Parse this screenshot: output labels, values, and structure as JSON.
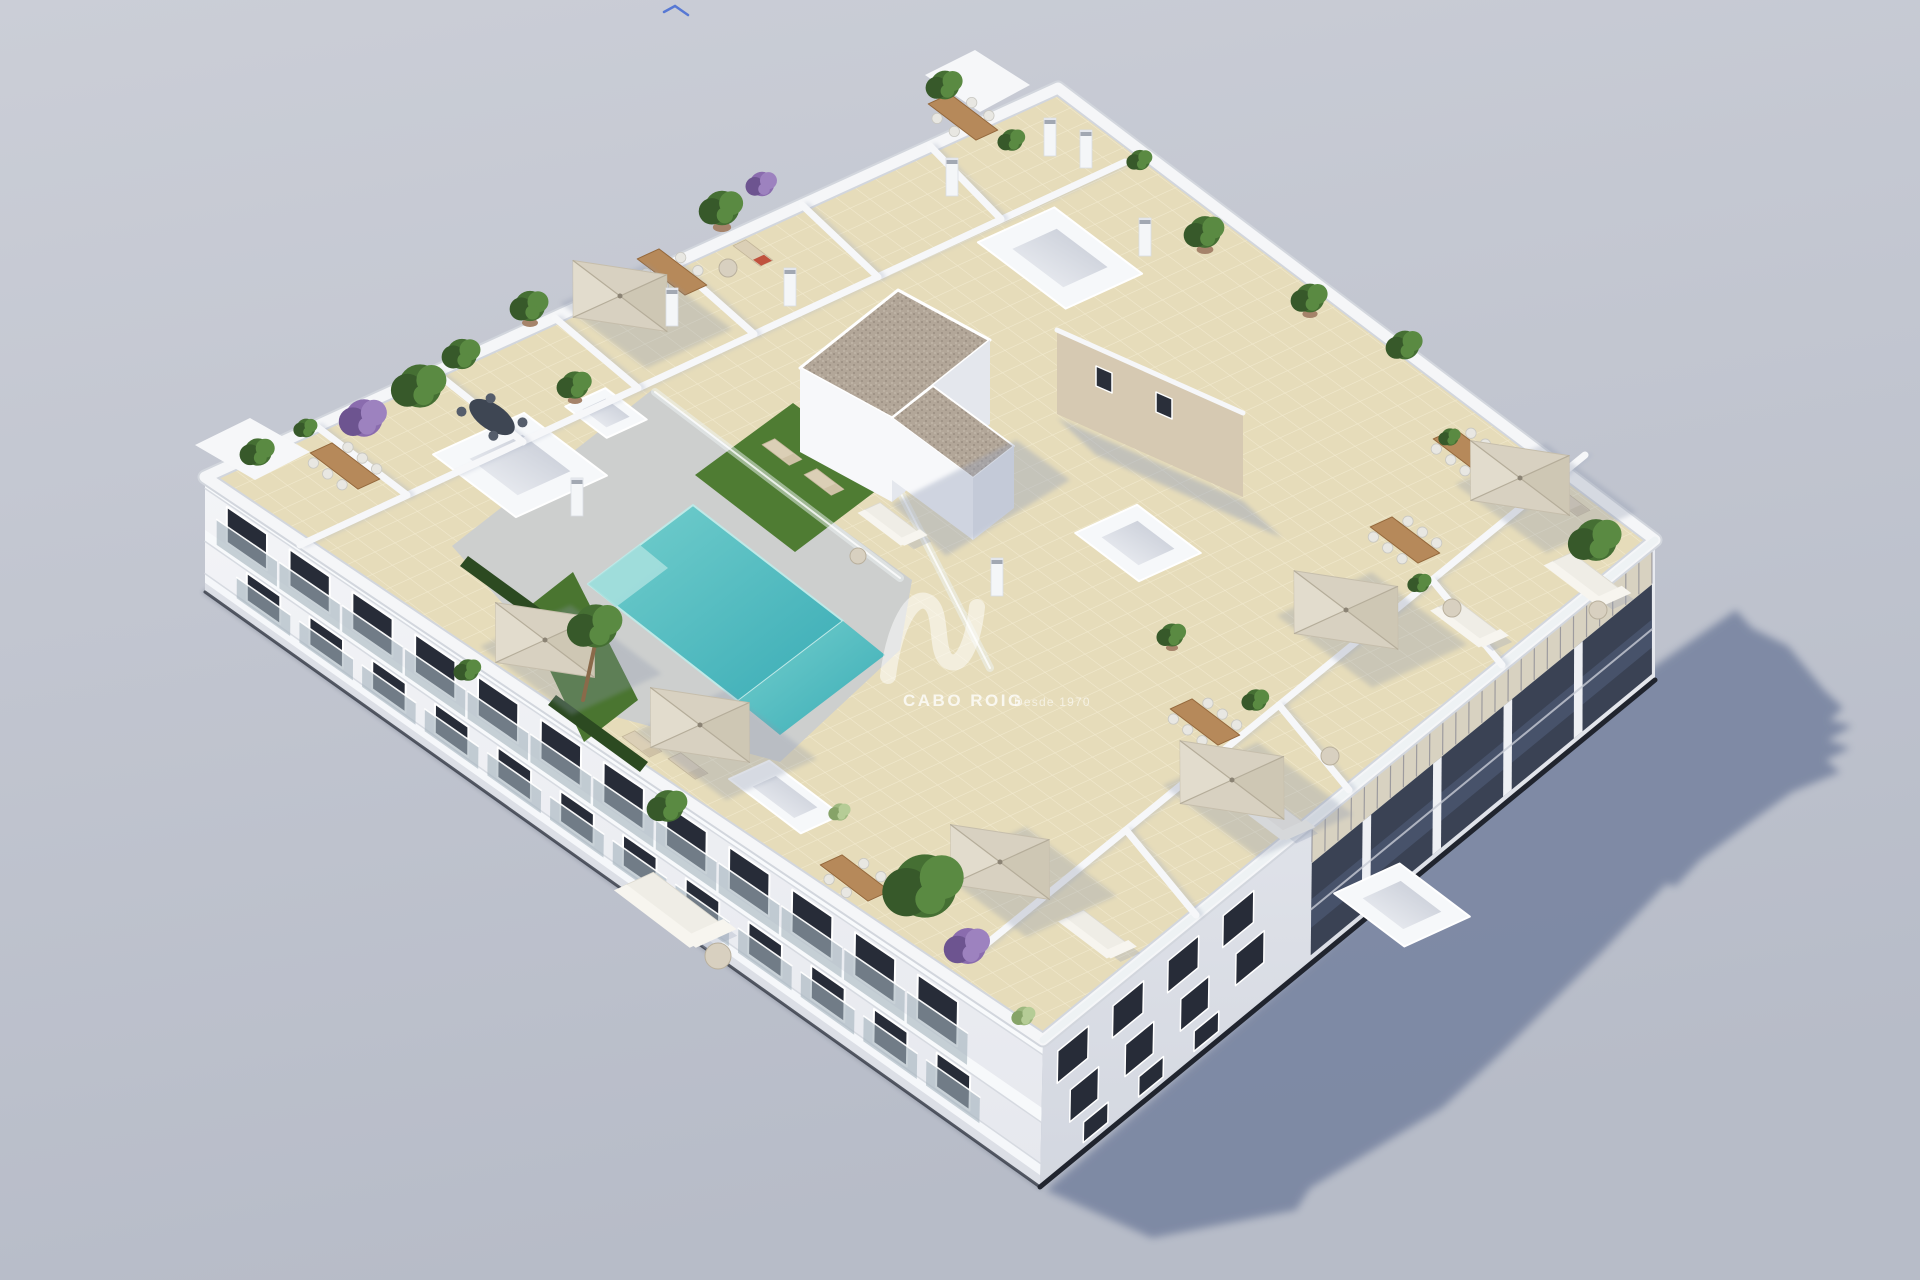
{
  "watermark": {
    "brand": "CABO ROIG",
    "tagline": "Desde 1970"
  },
  "palette": {
    "background_top": "#cbced7",
    "background_bottom": "#b7bcc8",
    "ground_shadow": "#7a86a2",
    "roof_tile": "#e6dcba",
    "grout": "#f2eacf",
    "wall_white": "#f5f6f8",
    "wall_shade": "#d7dae2",
    "tan_wall": "#d6c9b2",
    "pool_light": "#74cfcd",
    "pool_deep": "#3aacb6",
    "grass": "#4f7c33",
    "parasol": "#d8d1c1",
    "wood": "#b6895a",
    "gravel_roof": "#b2a698",
    "facade_recess": "#3a4254",
    "window_dark": "#272c38",
    "purple_bush": "#8a6cae"
  },
  "scene": {
    "u": [
      0.797,
      0.603
    ],
    "v": [
      -0.91,
      0.415
    ],
    "roof": {
      "quad": [
        [
          1058,
          88
        ],
        [
          1655,
          540
        ],
        [
          1043,
          1040
        ],
        [
          205,
          477
        ]
      ]
    },
    "facadeSW": {
      "top": [
        [
          205,
          477
        ],
        [
          1043,
          1040
        ]
      ],
      "bot": [
        [
          205,
          592
        ],
        [
          1040,
          1187
        ]
      ],
      "bands": [
        {
          "v0": 0.0,
          "v1": 0.1,
          "f": "#f8fafc"
        },
        {
          "v0": 0.46,
          "v1": 0.56,
          "f": "#f7f9fb"
        },
        {
          "v0": 0.84,
          "v1": 0.92,
          "f": "#f5f7fa"
        },
        {
          "v0": 0.92,
          "v1": 1.0,
          "f": "#dcdfe6"
        }
      ],
      "lines": [
        0.1,
        0.56,
        0.84
      ],
      "rows": [
        {
          "v0": 0.13,
          "v1": 0.44,
          "w": 0.048,
          "slots": [
            0.05,
            0.125,
            0.2,
            0.275,
            0.35,
            0.425,
            0.5,
            0.575,
            0.65,
            0.725,
            0.8,
            0.875
          ],
          "glass": [
            0.3,
            0.52
          ]
        },
        {
          "v0": 0.58,
          "v1": 0.82,
          "w": 0.04,
          "slots": [
            0.07,
            0.145,
            0.22,
            0.295,
            0.37,
            0.445,
            0.52,
            0.595,
            0.67,
            0.745,
            0.82,
            0.895
          ],
          "glass": [
            0.68,
            0.86
          ]
        }
      ]
    },
    "facadeSE": {
      "top": [
        [
          1043,
          1040
        ],
        [
          1655,
          540
        ]
      ],
      "bot": [
        [
          1040,
          1187
        ],
        [
          1655,
          680
        ]
      ],
      "winRows": [
        {
          "v0": 0.16,
          "v1": 0.38,
          "w": 0.05,
          "slots": [
            0.05,
            0.14,
            0.23,
            0.32
          ]
        },
        {
          "v0": 0.5,
          "v1": 0.72,
          "w": 0.046,
          "slots": [
            0.07,
            0.16,
            0.25,
            0.34
          ]
        },
        {
          "v0": 0.8,
          "v1": 0.94,
          "w": 0.04,
          "slots": [
            0.09,
            0.18,
            0.27
          ]
        }
      ],
      "pergola": {
        "t0": 0.44,
        "t1": 0.995,
        "v0": 0.02,
        "v1": 0.3,
        "slats": 26
      },
      "recess": {
        "t0": 0.44,
        "t1": 0.995,
        "v0": 0.3,
        "v1": 0.94,
        "piers": [
          0.53,
          0.645,
          0.76,
          0.875
        ],
        "pw": 0.014,
        "sheen": [
          0.55,
          0.75
        ]
      }
    },
    "items": [
      {
        "t": "poly",
        "name": "sky-ground",
        "p": "0,0 1920,0 1920,1280 0,1280",
        "f": "url(#gBg)"
      },
      {
        "t": "poly",
        "name": "building-cast-shadow",
        "f": "#7a86a2",
        "o": 0.92,
        "fl": "b4",
        "p": "1652,668 1736,610 1752,628 1788,646 1806,668 1824,690 1843,708 1830,720 1852,726 1828,740 1850,748 1826,760 1840,772 1792,792 1756,818 1700,860 1676,886 1666,884 1602,952 1502,1052 1442,1108 1310,1188 1296,1210 1152,1238 1046,1190"
      },
      {
        "t": "line",
        "name": "base-ao-sw",
        "a": [
          205,
          592
        ],
        "b": [
          1040,
          1187
        ],
        "s": "#79808f",
        "w": 5,
        "o": 0.45,
        "fl": "b2"
      },
      {
        "t": "facadeSW"
      },
      {
        "t": "facadeSE"
      },
      {
        "t": "roof"
      },
      {
        "t": "poly",
        "name": "pool-deck",
        "p": "452,546 652,390 912,580 900,650 780,762 598,712",
        "f": "#cdcfce"
      },
      {
        "t": "poly",
        "name": "grass-loungers",
        "p": "695,475 793,403 893,478 795,552",
        "f": "#4f7c33"
      },
      {
        "t": "poly",
        "name": "grass-side",
        "p": "522,612 573,572 638,700 584,742",
        "f": "#4a7530"
      },
      {
        "t": "poly",
        "name": "hedge",
        "p": "468,556 556,620 548,630 460,566",
        "f": "#2c4a21"
      },
      {
        "t": "poly",
        "name": "hedge",
        "p": "556,695 648,762 640,772 548,705",
        "f": "#2c4a21"
      },
      {
        "t": "poly",
        "name": "pool-main",
        "p": "588,584 693,505 843,621 738,701",
        "f": "url(#gPool)",
        "s": "#bfe9e7",
        "w": 2
      },
      {
        "t": "poly",
        "name": "pool-ext",
        "p": "738,701 843,621 885,655 780,735",
        "f": "url(#gPool)"
      },
      {
        "t": "poly",
        "name": "pool-steps",
        "p": "588,584 640,545 668,568 616,607",
        "f": "#a5dfdd",
        "o": 0.9
      },
      {
        "t": "fence",
        "a": [
          655,
          392
        ],
        "b": [
          900,
          578
        ]
      },
      {
        "t": "fence",
        "a": [
          895,
          482
        ],
        "b": [
          990,
          668
        ]
      },
      {
        "t": "lounger",
        "c": [
          782,
          452
        ]
      },
      {
        "t": "lounger",
        "c": [
          824,
          482
        ]
      },
      {
        "t": "lounger",
        "c": [
          642,
          744
        ]
      },
      {
        "t": "lounger",
        "c": [
          688,
          766
        ]
      },
      {
        "t": "poly",
        "name": "stair-core-roof",
        "p": "800,368 898,290 990,340 892,418",
        "f": "url(#pGravel)",
        "s": "#ffffff",
        "w": 3
      },
      {
        "t": "poly",
        "name": "stair-core-wall",
        "p": "800,368 892,418 892,502 800,452",
        "f": "#f7f8fa"
      },
      {
        "t": "poly",
        "name": "stair-core-wall-shade",
        "p": "892,418 990,340 990,424 892,502",
        "f": "#e4e7ed"
      },
      {
        "t": "poly",
        "name": "stair-core-roof",
        "p": "892,418 933,386 1014,446 973,478",
        "f": "url(#pGravel)",
        "s": "#ffffff",
        "w": 2
      },
      {
        "t": "poly",
        "name": "stair-core-wall",
        "p": "892,418 973,478 973,540 892,480",
        "f": "#f7f8fa"
      },
      {
        "t": "poly",
        "name": "stair-core-wall-shade",
        "p": "973,478 1014,446 1014,508 973,540",
        "f": "#e4e7ed"
      },
      {
        "t": "poly",
        "name": "stair-core-shadow",
        "p": "892,504 1016,440 1070,480 946,556",
        "f": "#96a1ba",
        "o": 0.4,
        "fl": "b2"
      },
      {
        "t": "poly",
        "name": "tan-wall",
        "p": "1057,330 1243,413 1243,497 1057,414",
        "f": "#d6c9b2"
      },
      {
        "t": "line",
        "name": "tan-wall-cap",
        "a": [
          1057,
          330
        ],
        "b": [
          1243,
          413
        ],
        "s": "#f6f7f9",
        "w": 5
      },
      {
        "t": "poly",
        "name": "tan-wall-window",
        "p": "1096,366 1112,373 1112,393 1096,386",
        "f": "#2a2f3a",
        "s": "#ffffff",
        "w": 1.5
      },
      {
        "t": "poly",
        "name": "tan-wall-window",
        "p": "1156,392 1172,399 1172,419 1156,412",
        "f": "#2a2f3a",
        "s": "#ffffff",
        "w": 1.5
      },
      {
        "t": "poly",
        "name": "tan-wall-shadow",
        "p": "1057,418 1243,501 1282,538 1096,455",
        "f": "#97a2bb",
        "o": 0.45,
        "fl": "b2"
      },
      {
        "t": "sky",
        "c": [
          1060,
          258
        ],
        "su": 55,
        "sv": 42
      },
      {
        "t": "sky",
        "c": [
          520,
          465
        ],
        "su": 52,
        "sv": 50
      },
      {
        "t": "sky",
        "c": [
          606,
          413
        ],
        "su": 26,
        "sv": 22
      },
      {
        "t": "sky",
        "c": [
          1402,
          905
        ],
        "su": 44,
        "sv": 36
      },
      {
        "t": "sky",
        "c": [
          785,
          797
        ],
        "su": 45,
        "sv": 22
      },
      {
        "t": "sky",
        "c": [
          1138,
          543
        ],
        "su": 40,
        "sv": 34
      },
      {
        "t": "wall",
        "a": [
          300,
          545
        ],
        "b": [
          1125,
          162
        ]
      },
      {
        "t": "wall",
        "a": [
          407,
          495
        ],
        "b": [
          316,
          426
        ]
      },
      {
        "t": "wall",
        "a": [
          523,
          442
        ],
        "b": [
          435,
          372
        ]
      },
      {
        "t": "wall",
        "a": [
          638,
          388
        ],
        "b": [
          555,
          318
        ]
      },
      {
        "t": "wall",
        "a": [
          754,
          334
        ],
        "b": [
          674,
          263
        ]
      },
      {
        "t": "wall",
        "a": [
          878,
          277
        ],
        "b": [
          802,
          205
        ]
      },
      {
        "t": "wall",
        "a": [
          1001,
          219
        ],
        "b": [
          930,
          146
        ]
      },
      {
        "t": "wall",
        "a": [
          973,
          955
        ],
        "b": [
          1585,
          455
        ]
      },
      {
        "t": "wall",
        "a": [
          1126,
          830
        ],
        "b": [
          1196,
          915
        ]
      },
      {
        "t": "wall",
        "a": [
          1279,
          705
        ],
        "b": [
          1349,
          790
        ]
      },
      {
        "t": "wall",
        "a": [
          1432,
          580
        ],
        "b": [
          1502,
          665
        ]
      },
      {
        "t": "poly",
        "name": "parapet-planter",
        "p": "195,445 250,418 310,452 255,480",
        "f": "#f6f7f9"
      },
      {
        "t": "poly",
        "name": "parapet-planter",
        "p": "925,75 975,50 1030,85 980,112",
        "f": "#f6f7f9"
      },
      {
        "t": "tableW",
        "c": [
          345,
          466
        ],
        "n": 6
      },
      {
        "t": "tableW",
        "c": [
          672,
          272
        ],
        "n": 4
      },
      {
        "t": "tableW",
        "c": [
          963,
          117
        ],
        "n": 4
      },
      {
        "t": "tableW",
        "c": [
          1468,
          452
        ],
        "n": 6
      },
      {
        "t": "tableW",
        "c": [
          1405,
          540
        ],
        "n": 6
      },
      {
        "t": "tableW",
        "c": [
          1205,
          722
        ],
        "n": 6
      },
      {
        "t": "tableW",
        "c": [
          855,
          878
        ],
        "n": 4
      },
      {
        "t": "tableD",
        "c": [
          492,
          417
        ]
      },
      {
        "t": "sofa",
        "c": [
          1588,
          578
        ],
        "s": 1
      },
      {
        "t": "sofa",
        "c": [
          1470,
          622
        ],
        "s": 0.9
      },
      {
        "t": "sofa",
        "c": [
          1272,
          812
        ],
        "s": 1
      },
      {
        "t": "sofa",
        "c": [
          1098,
          933
        ],
        "s": 0.9
      },
      {
        "t": "sofa",
        "c": [
          676,
          908
        ],
        "s": 1.4
      },
      {
        "t": "sofa",
        "c": [
          893,
          523
        ],
        "s": 0.8
      },
      {
        "t": "rtable",
        "c": [
          728,
          268
        ],
        "r": 9
      },
      {
        "t": "rtable",
        "c": [
          1598,
          610
        ],
        "r": 9
      },
      {
        "t": "rtable",
        "c": [
          1452,
          608
        ],
        "r": 9
      },
      {
        "t": "rtable",
        "c": [
          1330,
          756
        ],
        "r": 9
      },
      {
        "t": "rtable",
        "c": [
          718,
          956
        ],
        "r": 13
      },
      {
        "t": "rtable",
        "c": [
          858,
          556
        ],
        "r": 8
      },
      {
        "t": "lounger",
        "c": [
          1570,
          503
        ]
      },
      {
        "t": "lounger",
        "c": [
          753,
          253
        ],
        "red": 1
      },
      {
        "t": "parasol",
        "c": [
          545,
          640
        ],
        "s": 1
      },
      {
        "t": "parasol",
        "c": [
          700,
          725
        ],
        "s": 1
      },
      {
        "t": "parasol",
        "c": [
          620,
          296
        ],
        "s": 0.95
      },
      {
        "t": "parasol",
        "c": [
          1520,
          478
        ],
        "s": 1
      },
      {
        "t": "parasol",
        "c": [
          1346,
          610
        ],
        "s": 1.05
      },
      {
        "t": "parasol",
        "c": [
          1232,
          780
        ],
        "s": 1.05
      },
      {
        "t": "parasol",
        "c": [
          1000,
          862
        ],
        "s": 1
      },
      {
        "t": "trunk",
        "a": [
          583,
          700
        ],
        "b": [
          596,
          640
        ]
      },
      {
        "t": "plant",
        "c": [
          596,
          626
        ],
        "r": 30,
        "k": "g"
      },
      {
        "t": "plant",
        "c": [
          468,
          670
        ],
        "r": 15,
        "k": "g"
      },
      {
        "t": "plant",
        "c": [
          945,
          85
        ],
        "r": 20,
        "k": "g"
      },
      {
        "t": "plant",
        "c": [
          1012,
          140
        ],
        "r": 15,
        "k": "g"
      },
      {
        "t": "plant",
        "c": [
          258,
          452
        ],
        "r": 19,
        "k": "g"
      },
      {
        "t": "plant",
        "c": [
          306,
          428
        ],
        "r": 13,
        "k": "g"
      },
      {
        "t": "plant",
        "c": [
          364,
          418
        ],
        "r": 26,
        "k": "p"
      },
      {
        "t": "plant",
        "c": [
          420,
          386
        ],
        "r": 30,
        "k": "g"
      },
      {
        "t": "plant",
        "c": [
          462,
          354
        ],
        "r": 21,
        "k": "g"
      },
      {
        "t": "plant",
        "c": [
          530,
          306
        ],
        "r": 21,
        "k": "g",
        "pot": 1
      },
      {
        "t": "plant",
        "c": [
          575,
          385
        ],
        "r": 19,
        "k": "g",
        "pot": 1
      },
      {
        "t": "plant",
        "c": [
          722,
          208
        ],
        "r": 24,
        "k": "g",
        "pot": 1
      },
      {
        "t": "plant",
        "c": [
          762,
          184
        ],
        "r": 17,
        "k": "p"
      },
      {
        "t": "plant",
        "c": [
          1140,
          160
        ],
        "r": 14,
        "k": "g"
      },
      {
        "t": "plant",
        "c": [
          1205,
          232
        ],
        "r": 22,
        "k": "g",
        "pot": 1
      },
      {
        "t": "plant",
        "c": [
          1310,
          298
        ],
        "r": 20,
        "k": "g",
        "pot": 1
      },
      {
        "t": "plant",
        "c": [
          1405,
          345
        ],
        "r": 20,
        "k": "g"
      },
      {
        "t": "plant",
        "c": [
          1450,
          437
        ],
        "r": 12,
        "k": "g"
      },
      {
        "t": "plant",
        "c": [
          1596,
          540
        ],
        "r": 29,
        "k": "g"
      },
      {
        "t": "plant",
        "c": [
          1420,
          583
        ],
        "r": 13,
        "k": "g"
      },
      {
        "t": "plant",
        "c": [
          1256,
          700
        ],
        "r": 15,
        "k": "g"
      },
      {
        "t": "plant",
        "c": [
          1172,
          635
        ],
        "r": 16,
        "k": "g",
        "pot": 1
      },
      {
        "t": "plant",
        "c": [
          925,
          886
        ],
        "r": 44,
        "k": "g"
      },
      {
        "t": "plant",
        "c": [
          968,
          946
        ],
        "r": 25,
        "k": "p"
      },
      {
        "t": "plant",
        "c": [
          1024,
          1016
        ],
        "r": 13,
        "k": "l"
      },
      {
        "t": "plant",
        "c": [
          668,
          806
        ],
        "r": 22,
        "k": "g"
      },
      {
        "t": "plant",
        "c": [
          840,
          812
        ],
        "r": 12,
        "k": "l"
      },
      {
        "t": "pillar",
        "c": [
          672,
          322
        ]
      },
      {
        "t": "pillar",
        "c": [
          790,
          302
        ]
      },
      {
        "t": "pillar",
        "c": [
          952,
          192
        ]
      },
      {
        "t": "pillar",
        "c": [
          1050,
          152
        ]
      },
      {
        "t": "pillar",
        "c": [
          1086,
          164
        ]
      },
      {
        "t": "pillar",
        "c": [
          577,
          512
        ]
      },
      {
        "t": "pillar",
        "c": [
          997,
          592
        ]
      },
      {
        "t": "pillar",
        "c": [
          1145,
          252
        ]
      },
      {
        "t": "path",
        "name": "bird-artifact",
        "d": "M 664,12 l 11,-6 l 13,9",
        "s": "#4a6fd4",
        "w": 2.5,
        "o": 0.9
      }
    ]
  }
}
